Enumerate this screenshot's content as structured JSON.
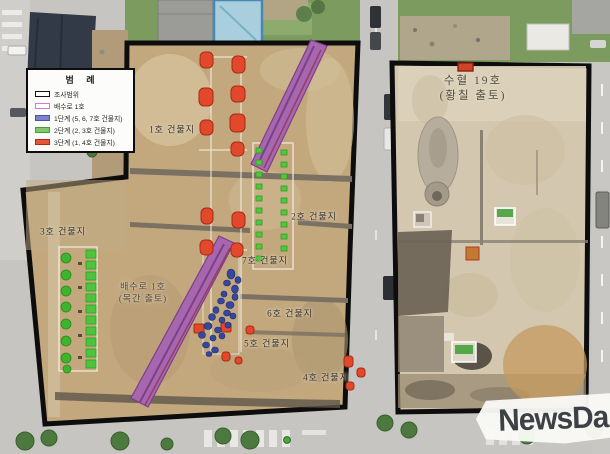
{
  "legend": {
    "title": "범 례",
    "items": [
      {
        "label": "조사범위",
        "fill": "#ffffff",
        "border": "#111111"
      },
      {
        "label": "배수로 1호",
        "fill": "#ffffff",
        "border": "#d779cc"
      },
      {
        "label": "1단계 (5, 6, 7호 건물지)",
        "fill": "#7b82c6",
        "border": "#4c52a8"
      },
      {
        "label": "2단계 (2, 3호 건물지)",
        "fill": "#82c671",
        "border": "#3f9e2f"
      },
      {
        "label": "3단계 (1, 4호 건물지)",
        "fill": "#e4573c",
        "border": "#b22a14"
      }
    ]
  },
  "site_labels": {
    "building1": "1호 건물지",
    "building2": "2호 건물지",
    "building3": "3호 건물지",
    "building4": "4호 건물지",
    "building5": "5호 건물지",
    "building6": "6호 건물지",
    "building7": "7호 건물지",
    "drain_line1": "배수로 1호",
    "drain_line2": "(목간 출토)",
    "pit_line1": "수혈 19호",
    "pit_line2": "(황칠 출토)"
  },
  "watermark": {
    "text": "NewsDa"
  },
  "colors": {
    "survey_border": "#0d0d0d",
    "drainage_purple": "#a767ae",
    "stage1_blue": "#35479f",
    "stage2_green": "#52c63e",
    "stage3_red": "#e2492c",
    "soil_left": "#c3a87e",
    "soil_right": "#d3c7b0"
  }
}
